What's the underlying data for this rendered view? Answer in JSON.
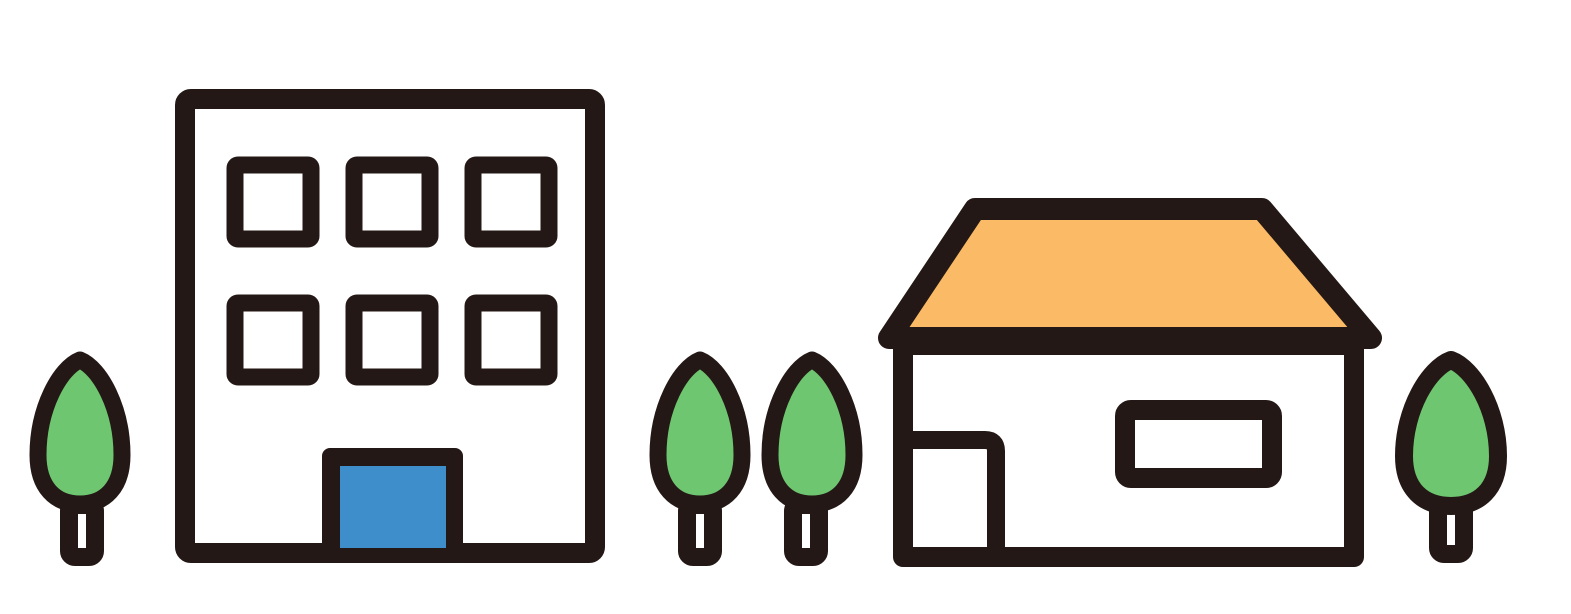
{
  "illustration": {
    "title": "Flat town illustration: office building and house with trees",
    "background": "#ffffff",
    "objects": [
      {
        "name": "small-tree-left",
        "type": "tree"
      },
      {
        "name": "office-building",
        "type": "building",
        "window_rows": 2,
        "windows_per_row": 3,
        "door_color": "#3E8ECB"
      },
      {
        "name": "tree-pair",
        "type": "trees",
        "count": 2
      },
      {
        "name": "house",
        "type": "house",
        "roof_color": "#FBBA66",
        "windows": 1,
        "doors": 1
      },
      {
        "name": "small-tree-right",
        "type": "tree"
      }
    ],
    "tree_count": 4
  },
  "colors": {
    "outline": "#231815",
    "white": "#ffffff",
    "green": "#6FC671",
    "orange": "#FBBA66",
    "blue": "#3E8ECB",
    "none": "none"
  }
}
